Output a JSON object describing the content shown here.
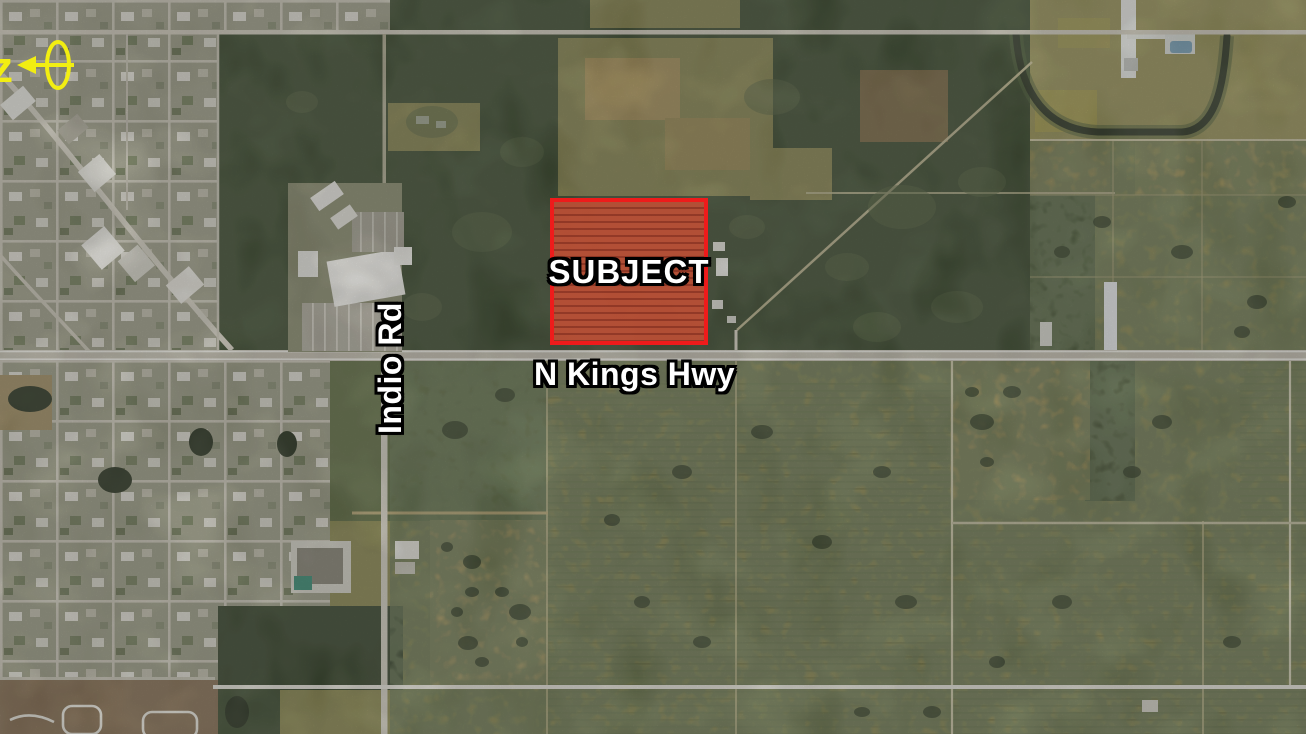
{
  "view": {
    "kind": "aerial-satellite-location-map",
    "subject_parcel": {
      "label": "SUBJECT",
      "border_color": "#ee1b1b",
      "fill_color": "#bb4f35"
    },
    "roads": {
      "highway_label": "N Kings Hwy",
      "cross_street_label": "Indio Rd"
    },
    "north_arrow": {
      "letter": "z",
      "color": "#f2ee12"
    },
    "label_style": {
      "text_color": "#ffffff",
      "outline_color": "#000000"
    }
  }
}
